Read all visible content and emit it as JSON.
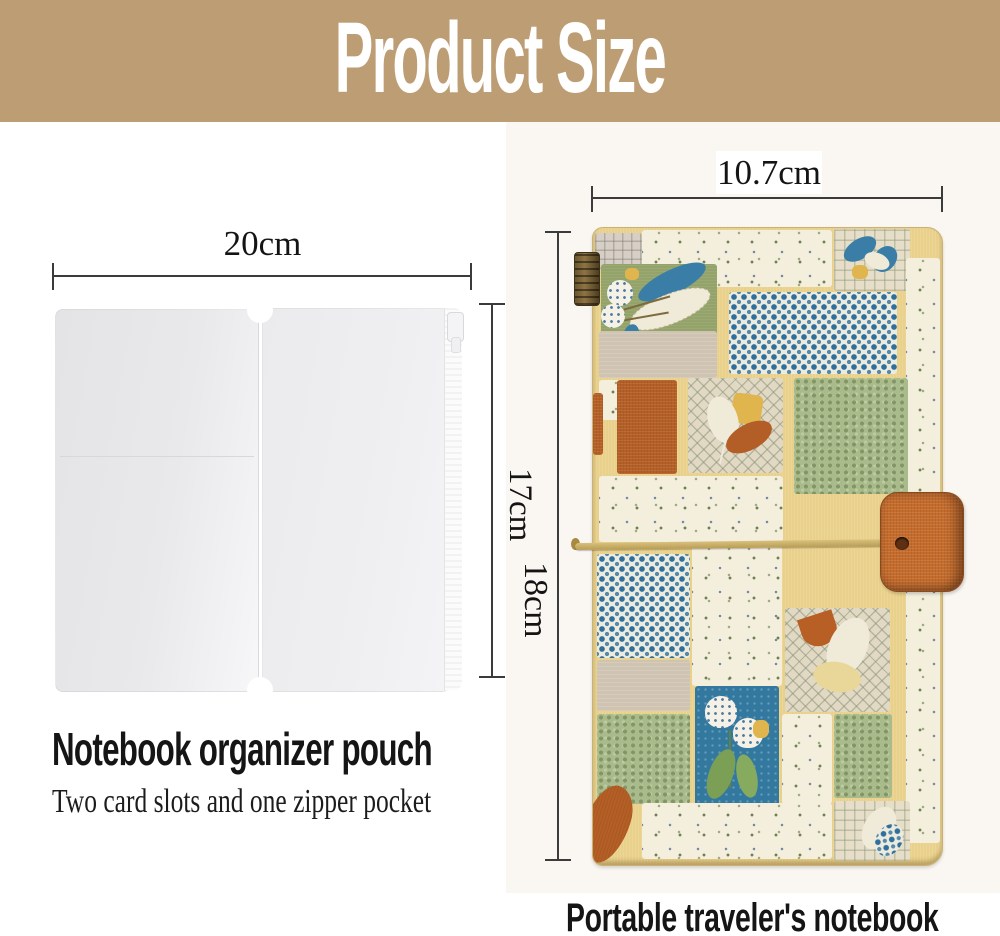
{
  "header": {
    "title": "Product Size",
    "bg_color": "#bd9e74",
    "text_color": "#ffffff"
  },
  "pouch": {
    "width_label": "20cm",
    "height_label": "17cm",
    "title": "Notebook organizer pouch",
    "subtitle": "Two card slots and one zipper pocket"
  },
  "notebook": {
    "width_label": "10.7cm",
    "height_label": "18cm",
    "title": "Portable traveler's notebook"
  },
  "colors": {
    "dimension_line": "#3b3b3b",
    "sash_yellow": "#e9d18c",
    "patch_blue": "#2e6f9b",
    "patch_sage": "#a9ba8b",
    "patch_orange": "#b55f26",
    "patch_teal": "#33789f",
    "clasp_orange": "#c56c2c",
    "cord_gold": "#c9ae66",
    "photo_backdrop": "#faf6f2"
  }
}
